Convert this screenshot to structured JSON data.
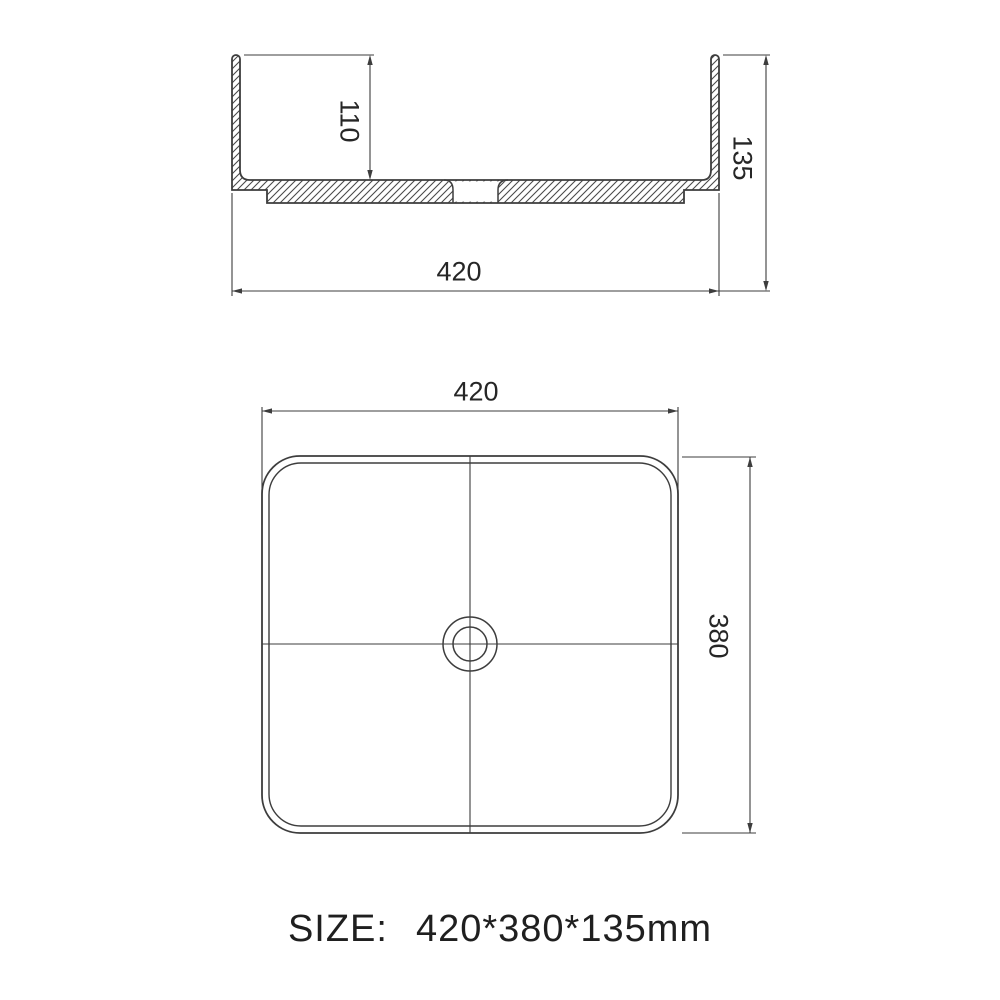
{
  "views": {
    "section": {
      "dim_inner_depth": "110",
      "dim_overall_width": "420",
      "dim_overall_height": "135"
    },
    "plan": {
      "dim_width": "420",
      "dim_depth": "380"
    }
  },
  "caption": {
    "label": "SIZE:",
    "value": "420*380*135mm"
  },
  "colors": {
    "line": "#3d3d3d",
    "hatch": "#4a4a4a",
    "text": "#262626",
    "background": "#ffffff"
  }
}
